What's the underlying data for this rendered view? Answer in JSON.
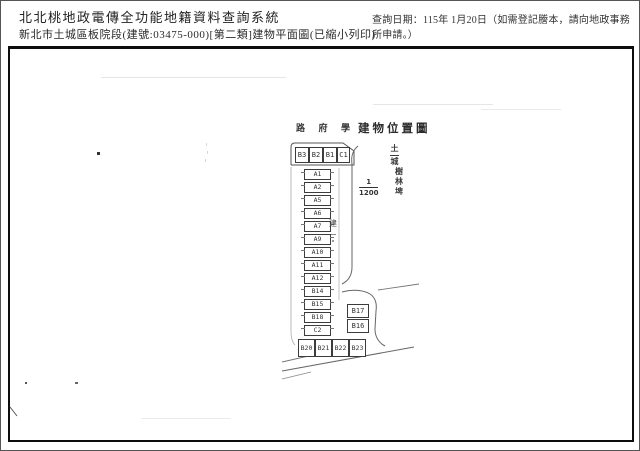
{
  "header": {
    "system_title": "北北桃地政電傳全功能地籍資料查詢系統",
    "document_subtitle": "新北市土城區板院段(建號:03475-000)[第二類]建物平面圖(已縮小列印)",
    "query_date_note": "查詢日期：115年 1月20日（如需登記謄本，請向地政事務所申請。）"
  },
  "plan": {
    "street_label_chars": [
      "路",
      "府",
      "學"
    ],
    "location_map_title": "建物位置圖",
    "scale": {
      "numerator": "1",
      "denominator": "1200"
    },
    "district_vertical_chars": [
      "土",
      "城"
    ],
    "place_vertical_chars": [
      "樹",
      "林",
      "埤"
    ],
    "side_note": "建",
    "top_row_units": [
      "B3",
      "B2",
      "B1",
      "C1"
    ],
    "stack_units": [
      "A1",
      "A2",
      "A5",
      "A6",
      "A7",
      "A9",
      "A10",
      "A11",
      "A12",
      "B14",
      "B15",
      "B18",
      "C2"
    ],
    "right_pair_units": [
      "B17",
      "B16"
    ],
    "bottom_row_units": [
      "B20",
      "B21",
      "B22",
      "B23"
    ]
  }
}
